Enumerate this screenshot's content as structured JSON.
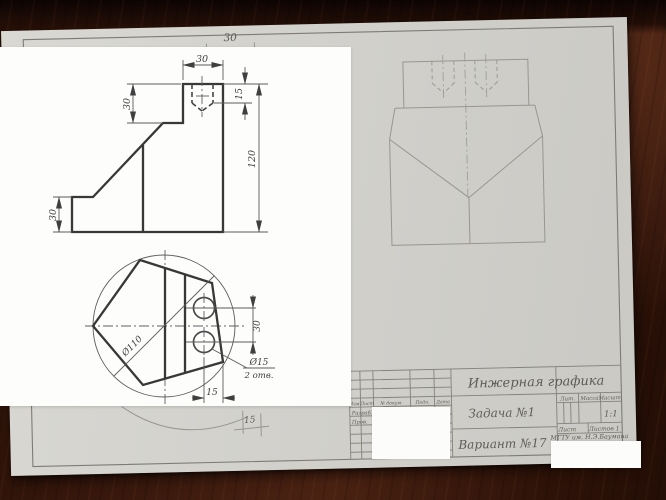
{
  "inset": {
    "front_view_dims": {
      "top_width": "30",
      "hole_depth": "15",
      "total_height": "120",
      "notch_depth": "30",
      "base_height": "30"
    },
    "top_view_dims": {
      "outer_diameter": "Ø110",
      "hole_spacing": "30",
      "hole_diameter": "Ø15",
      "hole_count": "2 отв.",
      "hole_edge_offset": "15"
    }
  },
  "sheet": {
    "top_dim": "30",
    "bottom_dim": "15",
    "title_block": {
      "discipline": "Инжерная графика",
      "task": "Задача №1",
      "variant": "Вариант №17",
      "col_izm": "Изм.",
      "col_list": "Лист",
      "col_doc": "№ докум.",
      "col_sign": "Подп.",
      "col_date": "Дата",
      "row_developed": "Разраб.",
      "row_checked": "Пров.",
      "lit_header": "Лит.",
      "mass_header": "Масса",
      "scale_header": "Масшт.",
      "scale_value": "1:1",
      "sheet_label": "Лист",
      "sheets_label": "Листов 1",
      "organization": "МГТУ им. Н.Э.Баумана"
    }
  }
}
